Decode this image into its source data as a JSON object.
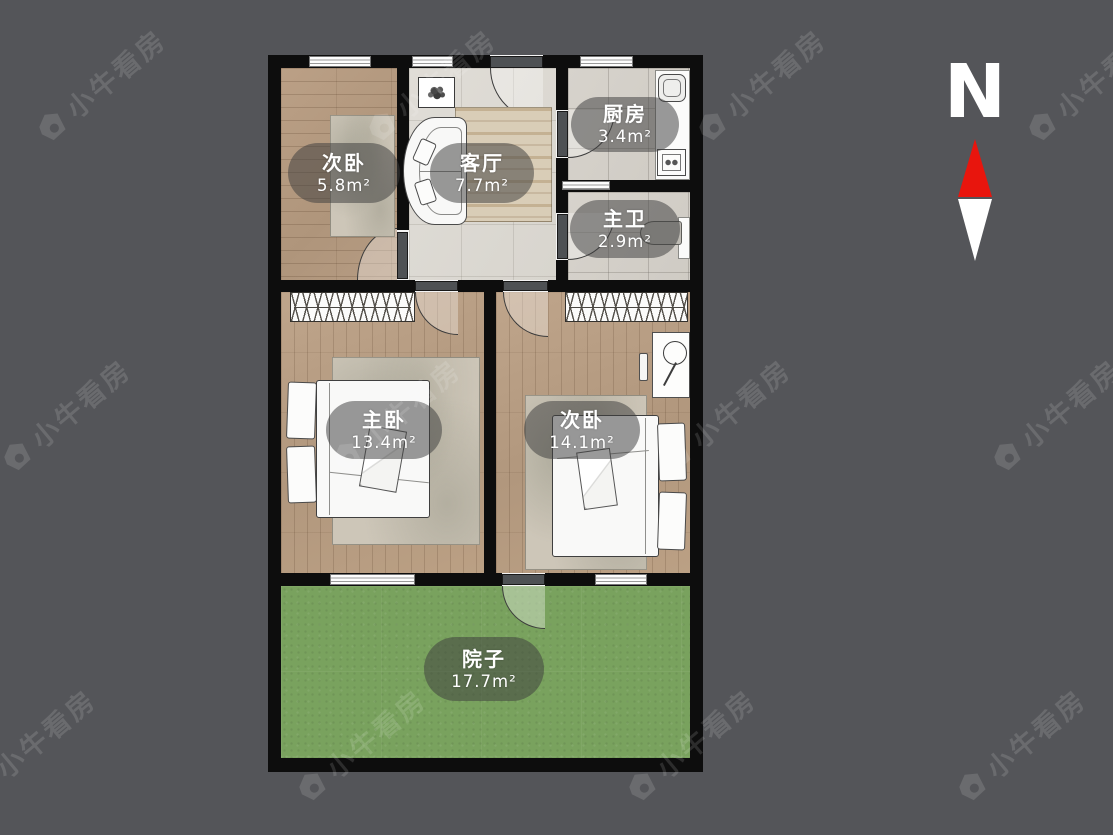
{
  "app": {
    "watermark_text": "小牛看房"
  },
  "compass": {
    "label": "N",
    "arrow_color": "#e8150d"
  },
  "floorplan": {
    "rooms": [
      {
        "key": "secondary-bedroom-top",
        "name": "次卧",
        "area": "5.8m²"
      },
      {
        "key": "living-room",
        "name": "客厅",
        "area": "7.7m²"
      },
      {
        "key": "kitchen",
        "name": "厨房",
        "area": "3.4m²"
      },
      {
        "key": "master-bath",
        "name": "主卫",
        "area": "2.9m²"
      },
      {
        "key": "master-bedroom",
        "name": "主卧",
        "area": "13.4m²"
      },
      {
        "key": "secondary-bedroom",
        "name": "次卧",
        "area": "14.1m²"
      },
      {
        "key": "courtyard",
        "name": "院子",
        "area": "17.7m²"
      }
    ],
    "colors": {
      "wall": "#0d0d0d",
      "grass": "#79a25e",
      "background": "#545559"
    }
  }
}
